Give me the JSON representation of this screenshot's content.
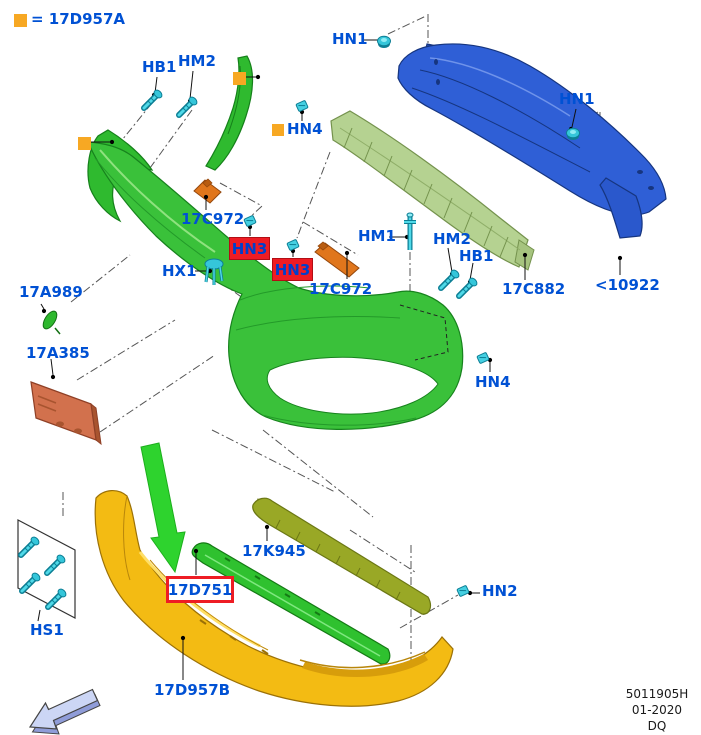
{
  "legend": {
    "marker": "orange-square",
    "text": "= 17D957A"
  },
  "callouts": {
    "hb1_top": "HB1",
    "hm2_top": "HM2",
    "hn1_left": "HN1",
    "hn1_right": "HN1",
    "hn4_top": "HN4",
    "hn4_bottom": "HN4",
    "c17c972_left": "17C972",
    "c17c972_right": "17C972",
    "hn3_box1": "HN3",
    "hn3_box2": "HN3",
    "hx1": "HX1",
    "hm1": "HM1",
    "hm2_mid": "HM2",
    "hb1_mid": "HB1",
    "c17c882": "17C882",
    "lt10922": "<10922",
    "c17a989": "17A989",
    "c17a385": "17A385",
    "hs1": "HS1",
    "c17d751": "17D751",
    "c17k945": "17K945",
    "hn2": "HN2",
    "c17d957b": "17D957B"
  },
  "footer": {
    "doc_number": "5011905H",
    "revision_date": "01-2020",
    "code": "DQ"
  },
  "colors": {
    "label_blue": "#0051d4",
    "callout_box_red": "#ee1c24",
    "legend_orange": "#f7a823",
    "part_green": "#3ac13a",
    "part_light_green": "#b5d291",
    "part_blue": "#2f5fd6",
    "part_yellow": "#f3bb13",
    "part_olive": "#99a826",
    "part_orange": "#e0761c",
    "fastener_cyan": "#35c6da"
  }
}
